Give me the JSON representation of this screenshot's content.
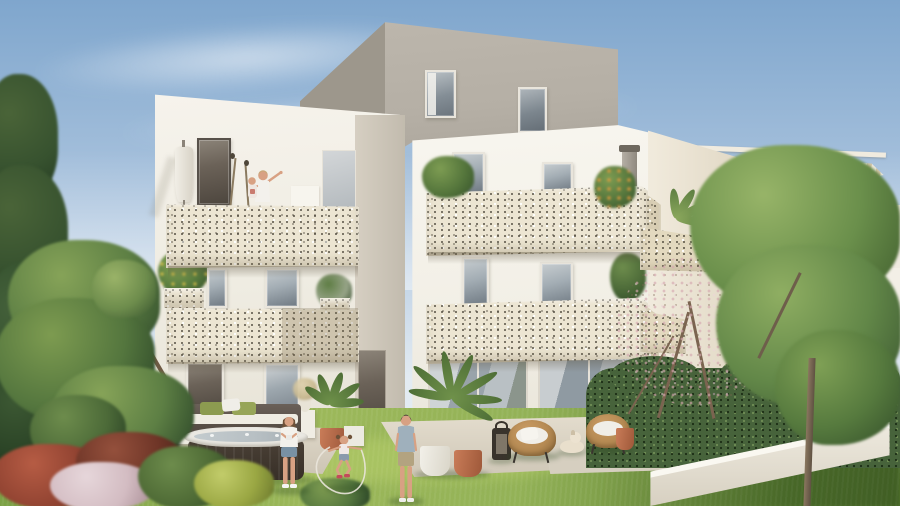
{
  "meta": {
    "title": "Architectural rendering of a modern white apartment residence with perforated balcony parapets and landscaped garden",
    "type": "3d-exterior-visualization"
  },
  "palette": {
    "sky_top": "#7fa6cd",
    "sky_mid": "#aec6df",
    "sky_horizon": "#e3ebf2",
    "cloud_white": "#ffffff",
    "wall_white": "#f3f0e8",
    "wall_bright": "#f8f6ef",
    "wall_shade": "#ddd6c9",
    "recess_gray": "#c9c2b5",
    "attic_front": "#b5afa5",
    "attic_side": "#9d978c",
    "panel_cream": "#ece5d2",
    "panel_shade": "#dcd2b8",
    "panel_dot": "#4e4a3c",
    "frame_white": "#e9e5dc",
    "frame_dark": "#57514a",
    "glass": "#a3adb4",
    "glass_dark": "#707a83",
    "glass_deep": "#4d5358",
    "canopy_beige": "#d2c5a8",
    "canopy_white": "#ede8db",
    "lawn_light": "#9cb85a",
    "lawn_mid": "#7aa045",
    "lawn_dark": "#55792f",
    "hedge_green": "#47633b",
    "hedge_dark": "#2e4426",
    "tree_light": "#8fae62",
    "tree_mid": "#628748",
    "tree_dark": "#3c5831",
    "conifer_dark": "#37522f",
    "blossom_pink": "#cfa3aa",
    "branch_brown": "#7b6450",
    "trunk_brown": "#7d6a55",
    "shrub_red": "#8e4130",
    "shrub_wine": "#6e3527",
    "shrub_pink": "#d3bcc2",
    "shrub_yellow": "#9aa743",
    "shrub_green": "#4e6a35",
    "terrace_light": "#e0d9ca",
    "terrace_shade": "#c9c1b1",
    "tub_dark": "#43392f",
    "tub_rim": "#eae8e2",
    "water_gray": "#b7bfc3",
    "cushion_green": "#8c9b50",
    "pillow_white": "#f0eee8",
    "wicker_tan": "#b58a53",
    "wicker_dark": "#8f6a3c",
    "terracotta": "#bb6e4e",
    "pot_white": "#eceae3",
    "lantern_black": "#39332c",
    "skin_tan": "#d8a183",
    "hair_brown": "#6e5138",
    "hair_dark": "#3f3a33",
    "hair_blond": "#c9a878",
    "denim_blue": "#7991a4",
    "khaki_beige": "#b3a380",
    "tee_blue": "#9fb0bc",
    "cloth_white": "#f3f1ec",
    "metal_gray": "#9a948a"
  },
  "scene": {
    "sky": {
      "label": "blue sky with wispy white clouds"
    },
    "buildings": {
      "main": {
        "label": "white four-storey apartment building with cream perforated balcony parapets",
        "attic_label": "grey set-back attic storey with two windows",
        "balcony_label": "cream perforated terrazzo balcony parapet"
      },
      "neighbor": {
        "label": "neighbouring penthouse with slatted timber pergola canopy"
      },
      "far_right": {
        "label": "white building with dark windows glimpsed behind the trees"
      }
    },
    "people": {
      "balcony": {
        "label": "adult holding a child and pointing at the sky on the roof terrace"
      },
      "woman": {
        "label": "woman in white t-shirt and denim shorts standing on the lawn"
      },
      "child": {
        "label": "girl jumping rope on the lawn"
      },
      "man": {
        "label": "man in blue t-shirt and beige shorts watching from the lawn"
      }
    },
    "animals": {
      "dog": {
        "label": "small cream dog resting on the terrace"
      }
    },
    "furniture": {
      "hot_tub": {
        "label": "dark-sided hot tub spa on the left terrace"
      },
      "bench": {
        "label": "outdoor sofa with green cushions behind the hot tub"
      },
      "wicker_chairs": {
        "label": "round rattan lounge chairs with white cushions"
      },
      "lantern": {
        "label": "black floor lantern on the terrace"
      },
      "parasol": {
        "label": "closed white parasol on the roof terrace"
      },
      "planters": {
        "label": "potted palms, citrus trees and terracotta pots"
      }
    },
    "landscape": {
      "lawn": {
        "label": "sunlit sloping lawn"
      },
      "hedge": {
        "label": "clipped dark green hedge"
      },
      "left_tree": {
        "label": "large deciduous garden tree"
      },
      "conifer": {
        "label": "tall dark conifer at the left edge"
      },
      "right_tree": {
        "label": "young green tree with slender trunk"
      },
      "blossom_tree": {
        "label": "bare twiggy tree with pale pink blossom"
      },
      "shrubs": {
        "label": "red, pink, green and yellow flowering shrubs"
      },
      "wall": {
        "label": "low white garden retaining wall"
      }
    }
  }
}
